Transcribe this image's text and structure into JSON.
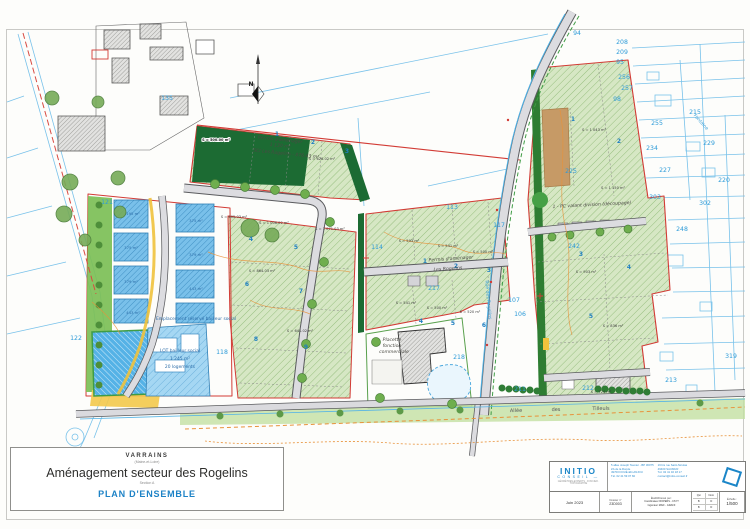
{
  "title_block": {
    "commune": "VARRAINS",
    "commune_sub": "(Maine-et-Loire)",
    "title": "Aménagement secteur des Rogelins",
    "title_sub": "Section A",
    "doc_title": "PLAN D'ENSEMBLE"
  },
  "firm_block": {
    "logo_line1": "INITIO",
    "logo_line2": "CONSEIL —",
    "logo_tagline": "GÉOMÈTRES-EXPERTS · FONCIER · TOPOGRAPHIE",
    "address1": [
      "5 allée Joseph Taunier - BP 30075",
      "ZA de la Ronde",
      "49700 DOUÉ-EN-ANJOU",
      "Tél. 02 41 59 07 82"
    ],
    "address2": [
      "16 bis rue Saint-Nicolas",
      "49400 SAUMUR",
      "Tél. 02 41 40 18 17",
      "contact@initio-conseil.fr"
    ],
    "date": "Juin 2023",
    "dossier_label": "Dossier n°",
    "dossier_num": "23D003",
    "etabli_label": "Établi/Dressé par :",
    "etabli_lines": [
      "Coordinateur ROPERS - CSYT",
      "Ingénieur MAIF - GRAFF"
    ],
    "col_qui": "Qui",
    "col_nom": "Nom",
    "rows": [
      [
        "B",
        "D"
      ],
      [
        "B",
        "D"
      ]
    ],
    "echelle_label": "Échelle :",
    "echelle": "1/500"
  },
  "colors": {
    "accent_blue": "#1d82c6",
    "cadastral_blue": "#79c2ea",
    "boundary_red": "#d23b35",
    "lot_green": "#d6e7c4",
    "hedge_green": "#1c6b33",
    "water_blue": "#55b2e6",
    "path_yellow": "#f0c23c",
    "contour_orange": "#e8923a"
  },
  "map": {
    "labels": [
      {
        "t": "135",
        "x": 167,
        "y": 100,
        "c": "cad"
      },
      {
        "t": "121",
        "x": 107,
        "y": 204,
        "c": "cad"
      },
      {
        "t": "122",
        "x": 76,
        "y": 340,
        "c": "cad"
      },
      {
        "t": "118",
        "x": 222,
        "y": 354,
        "c": "cad"
      },
      {
        "t": "113",
        "x": 452,
        "y": 209,
        "c": "cad"
      },
      {
        "t": "114",
        "x": 377,
        "y": 249,
        "c": "cad"
      },
      {
        "t": "117",
        "x": 499,
        "y": 227,
        "c": "cad"
      },
      {
        "t": "107",
        "x": 514,
        "y": 302,
        "c": "cad"
      },
      {
        "t": "106",
        "x": 520,
        "y": 316,
        "c": "cad"
      },
      {
        "t": "217",
        "x": 434,
        "y": 290,
        "c": "cad"
      },
      {
        "t": "218",
        "x": 459,
        "y": 359,
        "c": "cad"
      },
      {
        "t": "242",
        "x": 574,
        "y": 248,
        "c": "cad"
      },
      {
        "t": "225",
        "x": 571,
        "y": 173,
        "c": "cad"
      },
      {
        "t": "94",
        "x": 577,
        "y": 35,
        "c": "cad"
      },
      {
        "t": "208",
        "x": 622,
        "y": 44,
        "c": "cad"
      },
      {
        "t": "209",
        "x": 622,
        "y": 54,
        "c": "cad"
      },
      {
        "t": "95",
        "x": 620,
        "y": 64,
        "c": "cad"
      },
      {
        "t": "256",
        "x": 624,
        "y": 79,
        "c": "cad"
      },
      {
        "t": "257",
        "x": 627,
        "y": 90,
        "c": "cad"
      },
      {
        "t": "98",
        "x": 617,
        "y": 101,
        "c": "cad"
      },
      {
        "t": "255",
        "x": 657,
        "y": 125,
        "c": "cad"
      },
      {
        "t": "215",
        "x": 695,
        "y": 114,
        "c": "cad"
      },
      {
        "t": "234",
        "x": 652,
        "y": 150,
        "c": "cad"
      },
      {
        "t": "229",
        "x": 709,
        "y": 145,
        "c": "cad"
      },
      {
        "t": "227",
        "x": 665,
        "y": 172,
        "c": "cad"
      },
      {
        "t": "220",
        "x": 724,
        "y": 182,
        "c": "cad"
      },
      {
        "t": "303",
        "x": 655,
        "y": 199,
        "c": "cad"
      },
      {
        "t": "302",
        "x": 705,
        "y": 205,
        "c": "cad"
      },
      {
        "t": "248",
        "x": 682,
        "y": 231,
        "c": "cad"
      },
      {
        "t": "319",
        "x": 731,
        "y": 358,
        "c": "cad"
      },
      {
        "t": "213",
        "x": 671,
        "y": 382,
        "c": "cad"
      },
      {
        "t": "211",
        "x": 520,
        "y": 391,
        "c": "cad"
      },
      {
        "t": "212",
        "x": 588,
        "y": 390,
        "c": "cad"
      },
      {
        "t": "1",
        "x": 277,
        "y": 136,
        "c": "lot"
      },
      {
        "t": "2",
        "x": 313,
        "y": 144,
        "c": "lot"
      },
      {
        "t": "3",
        "x": 347,
        "y": 153,
        "c": "lot"
      },
      {
        "t": "4",
        "x": 251,
        "y": 241,
        "c": "lot"
      },
      {
        "t": "5",
        "x": 296,
        "y": 249,
        "c": "lot"
      },
      {
        "t": "6",
        "x": 247,
        "y": 286,
        "c": "lot"
      },
      {
        "t": "7",
        "x": 301,
        "y": 293,
        "c": "lot"
      },
      {
        "t": "8",
        "x": 256,
        "y": 341,
        "c": "lot"
      },
      {
        "t": "9",
        "x": 306,
        "y": 349,
        "c": "lot"
      },
      {
        "t": "1",
        "x": 425,
        "y": 263,
        "c": "lot"
      },
      {
        "t": "2",
        "x": 456,
        "y": 268,
        "c": "lot"
      },
      {
        "t": "3",
        "x": 489,
        "y": 272,
        "c": "lot"
      },
      {
        "t": "4",
        "x": 421,
        "y": 323,
        "c": "lot"
      },
      {
        "t": "5",
        "x": 453,
        "y": 325,
        "c": "lot"
      },
      {
        "t": "6",
        "x": 484,
        "y": 327,
        "c": "lot"
      },
      {
        "t": "1",
        "x": 573,
        "y": 121,
        "c": "lot"
      },
      {
        "t": "2",
        "x": 619,
        "y": 143,
        "c": "lot"
      },
      {
        "t": "3",
        "x": 581,
        "y": 256,
        "c": "lot"
      },
      {
        "t": "4",
        "x": 629,
        "y": 269,
        "c": "lot"
      },
      {
        "t": "5",
        "x": 591,
        "y": 318,
        "c": "lot"
      },
      {
        "t": "S = 605.03 m²",
        "x": 234,
        "y": 218,
        "c": "area"
      },
      {
        "t": "S = 1 006.02 m²",
        "x": 274,
        "y": 224,
        "c": "area"
      },
      {
        "t": "S = 1 071.03 m²",
        "x": 330,
        "y": 230,
        "c": "area"
      },
      {
        "t": "S = 626.02 m²",
        "x": 322,
        "y": 160,
        "c": "area"
      },
      {
        "t": "S = 864.03 m²",
        "x": 262,
        "y": 272,
        "c": "area"
      },
      {
        "t": "S = 641.02 m²",
        "x": 300,
        "y": 332,
        "c": "area"
      },
      {
        "t": "S = 593 m²",
        "x": 409,
        "y": 242,
        "c": "area"
      },
      {
        "t": "S = 541 m²",
        "x": 448,
        "y": 247,
        "c": "area"
      },
      {
        "t": "S = 500 m²",
        "x": 483,
        "y": 253,
        "c": "area"
      },
      {
        "t": "S = 541 m²",
        "x": 406,
        "y": 304,
        "c": "area"
      },
      {
        "t": "S = 500 m²",
        "x": 437,
        "y": 309,
        "c": "area"
      },
      {
        "t": "S = 520 m²",
        "x": 470,
        "y": 313,
        "c": "area"
      },
      {
        "t": "S = 1 043 m²",
        "x": 594,
        "y": 131,
        "c": "area"
      },
      {
        "t": "S = 1 150 m²",
        "x": 613,
        "y": 189,
        "c": "area"
      },
      {
        "t": "S = 903 m²",
        "x": 586,
        "y": 273,
        "c": "area"
      },
      {
        "t": "S = 836 m²",
        "x": 613,
        "y": 327,
        "c": "area"
      },
      {
        "t": "S = 724 m²",
        "x": 601,
        "y": 393,
        "c": "area"
      },
      {
        "t": "S = 500.00 m²",
        "x": 216,
        "y": 141,
        "c": "whitebox"
      },
      {
        "t": "195 m²",
        "x": 133,
        "y": 215,
        "c": "areaB"
      },
      {
        "t": "375 m²",
        "x": 131,
        "y": 249,
        "c": "areaB"
      },
      {
        "t": "379 m²",
        "x": 131,
        "y": 283,
        "c": "areaB"
      },
      {
        "t": "443 m²",
        "x": 133,
        "y": 314,
        "c": "areaB"
      },
      {
        "t": "375 m²",
        "x": 196,
        "y": 222,
        "c": "areaB"
      },
      {
        "t": "379 m²",
        "x": 196,
        "y": 256,
        "c": "areaB"
      },
      {
        "t": "443 m²",
        "x": 196,
        "y": 290,
        "c": "areaB"
      },
      {
        "t": "Permis d'aménager",
        "x": 280,
        "y": 141,
        "c": "name",
        "r": 6
      },
      {
        "t": "1 130 m²",
        "x": 280,
        "y": 147,
        "c": "name",
        "r": 6
      },
      {
        "t": "SCI Les Rogelins - 876.43 m²",
        "x": 286,
        "y": 155,
        "c": "name",
        "r": 6
      },
      {
        "t": "Permis d'aménager",
        "x": 451,
        "y": 260,
        "c": "name",
        "r": -4
      },
      {
        "t": "Les Rogelins",
        "x": 448,
        "y": 270,
        "c": "name",
        "r": -4
      },
      {
        "t": "1 - PC valant division (découpage)",
        "x": 592,
        "y": 206,
        "c": "name",
        "r": -3
      },
      {
        "t": "Placette",
        "x": 392,
        "y": 341,
        "c": "name"
      },
      {
        "t": "fonction",
        "x": 392,
        "y": 347,
        "c": "name"
      },
      {
        "t": "commerciale",
        "x": 394,
        "y": 353,
        "c": "name"
      },
      {
        "t": "Emplacement réservé bailleur social",
        "x": 196,
        "y": 320,
        "c": "nameB"
      },
      {
        "t": "LOT bailleur social",
        "x": 180,
        "y": 352,
        "c": "nameB"
      },
      {
        "t": "1 245 m²",
        "x": 180,
        "y": 360,
        "c": "nameB"
      },
      {
        "t": "20 logements",
        "x": 180,
        "y": 368,
        "c": "nameB"
      },
      {
        "t": "Allée",
        "x": 516,
        "y": 412,
        "c": "road",
        "r": -1
      },
      {
        "t": "des",
        "x": 556,
        "y": 411,
        "c": "road",
        "r": -1
      },
      {
        "t": "Tilleuls",
        "x": 601,
        "y": 410,
        "c": "road",
        "r": -1
      },
      {
        "t": "Rue des Rogelins",
        "x": 487,
        "y": 300,
        "c": "roadB",
        "r": 85
      },
      {
        "t": "Fontaine",
        "x": 700,
        "y": 123,
        "c": "roadB",
        "r": 48
      },
      {
        "t": "N",
        "x": 251,
        "y": 86,
        "c": "north"
      }
    ]
  }
}
